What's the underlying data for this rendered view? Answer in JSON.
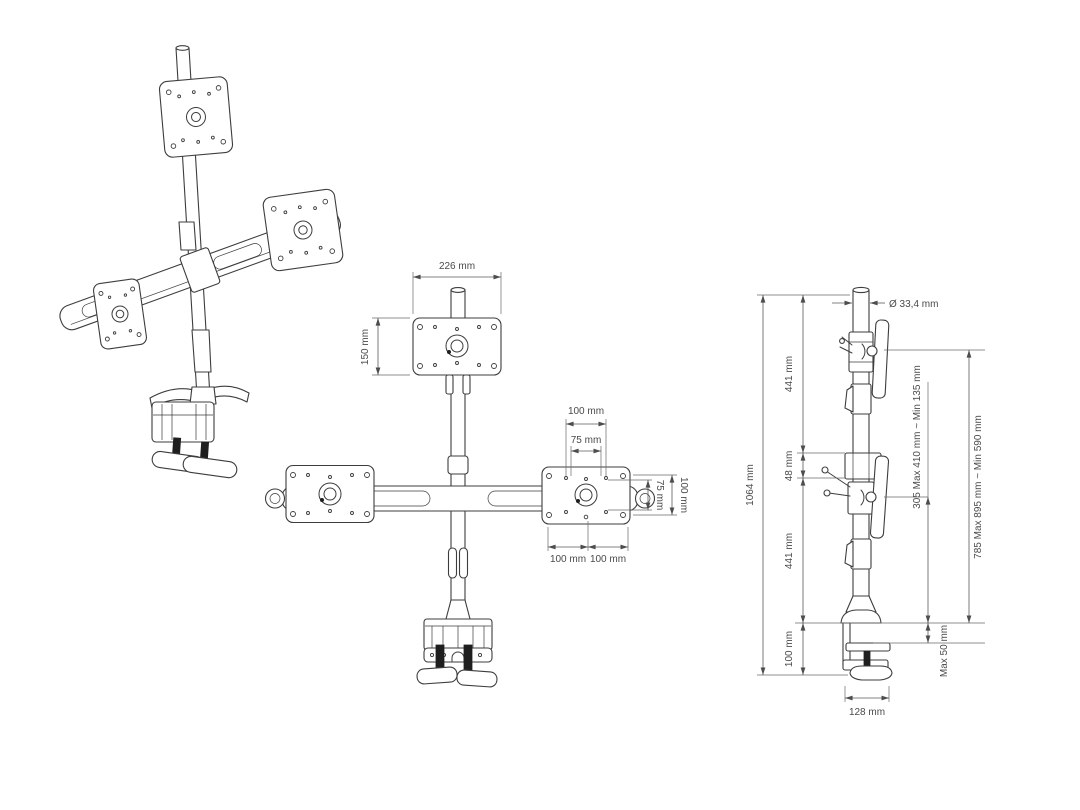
{
  "front_view": {
    "dim_plate_width": "226 mm",
    "dim_plate_height": "150 mm",
    "dim_vesa_width_100": "100 mm",
    "dim_vesa_width_75": "75 mm",
    "dim_vesa_height_75": "75 mm",
    "dim_vesa_height_100": "100 mm",
    "dim_arm_left_100": "100 mm",
    "dim_arm_right_100": "100 mm"
  },
  "side_view": {
    "dim_total_height": "1064 mm",
    "dim_upper_section": "441 mm",
    "dim_crossbar_joint": "48 mm",
    "dim_lower_section": "441 mm",
    "dim_base_section": "100 mm",
    "dim_pole_diameter": "Ø 33,4 mm",
    "dim_mid_monitor_height": "305 Max 410 mm ~ Min 135 mm",
    "dim_top_monitor_height": "785 Max 895 mm ~ Min 590 mm",
    "dim_desk_thickness": "Max 50 mm",
    "dim_clamp_depth": "128 mm"
  },
  "colors": {
    "background": "#ffffff",
    "drawing_line": "#3d3d3d",
    "dimension_line": "#5a5a5a",
    "dimension_text": "#4a4a4a"
  }
}
